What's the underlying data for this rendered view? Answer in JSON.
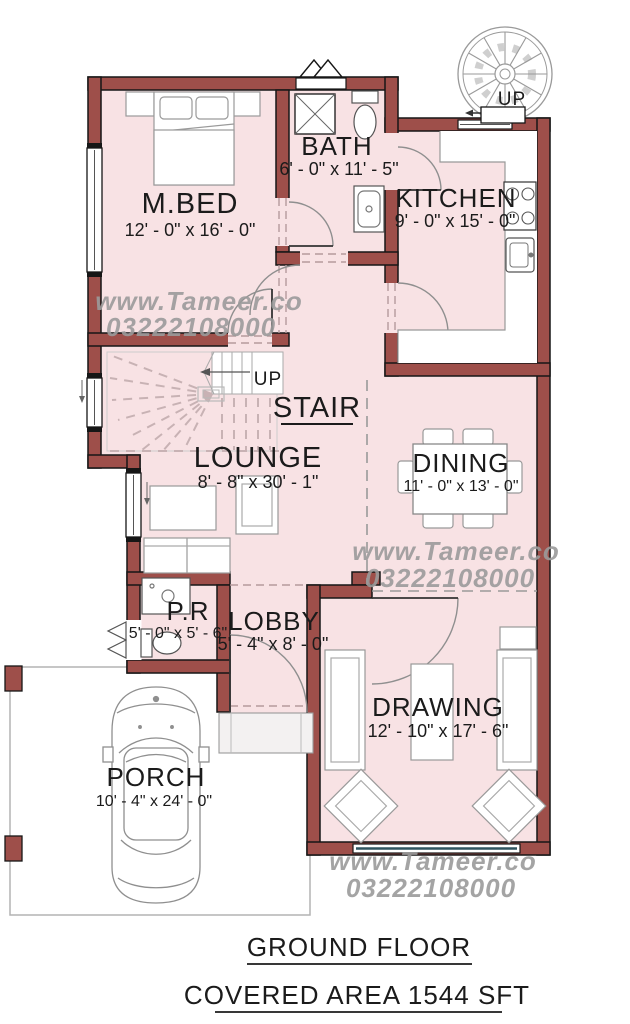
{
  "colors": {
    "wall": "#9e4f4a",
    "room_fill": "#f8e2e4",
    "watermark": "#9b9b9b",
    "outline": "#161616"
  },
  "watermark": {
    "line1": "www.Tameer.co",
    "line2": "03222108000"
  },
  "rooms": [
    {
      "name": "M.BED",
      "dims": "12' - 0\" x 16' - 0\""
    },
    {
      "name": "BATH",
      "dims": "6' - 0\" x 11' - 5\""
    },
    {
      "name": "KITCHEN",
      "dims": "9' - 0\" x 15' - 0\""
    },
    {
      "name": "STAIR",
      "dims": ""
    },
    {
      "name": "LOUNGE",
      "dims": "8' - 8\" x 30' - 1\""
    },
    {
      "name": "DINING",
      "dims": "11' - 0\" x 13' - 0\""
    },
    {
      "name": "P.R",
      "dims": "5' - 0\" x 5' - 6\""
    },
    {
      "name": "LOBBY",
      "dims": "5' - 4\" x 8' - 0\""
    },
    {
      "name": "DRAWING",
      "dims": "12' - 10\" x 17' - 6\""
    },
    {
      "name": "PORCH",
      "dims": "10' - 4\" x 24' - 0\""
    }
  ],
  "stair": {
    "up_label": "UP"
  },
  "spiral_stair": {
    "up_label": "UP"
  },
  "footer": {
    "title": "GROUND FLOOR",
    "subtitle": "COVERED AREA 1544 SFT"
  }
}
